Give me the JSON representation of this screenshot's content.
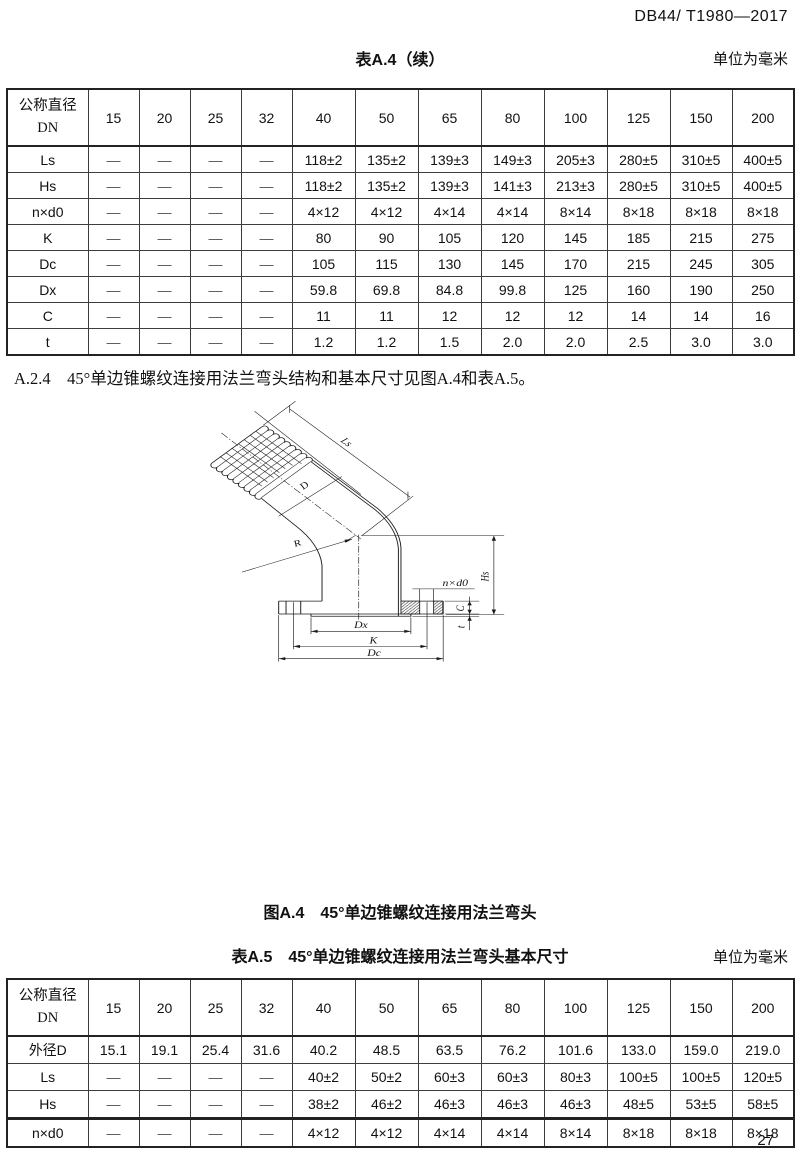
{
  "page": {
    "doc_code": "DB44/ T1980—2017",
    "page_number": "27"
  },
  "table_a4": {
    "title": "表A.4（续）",
    "unit_note": "单位为毫米",
    "header": {
      "label_line1": "公称直径",
      "label_line2": "DN",
      "columns": [
        "15",
        "20",
        "25",
        "32",
        "40",
        "50",
        "65",
        "80",
        "100",
        "125",
        "150",
        "200"
      ]
    },
    "rows": [
      {
        "label": "Ls",
        "values": [
          "—",
          "—",
          "—",
          "—",
          "118±2",
          "135±2",
          "139±3",
          "149±3",
          "205±3",
          "280±5",
          "310±5",
          "400±5"
        ]
      },
      {
        "label": "Hs",
        "values": [
          "—",
          "—",
          "—",
          "—",
          "118±2",
          "135±2",
          "139±3",
          "141±3",
          "213±3",
          "280±5",
          "310±5",
          "400±5"
        ]
      },
      {
        "label": "n×d0",
        "values": [
          "—",
          "—",
          "—",
          "—",
          "4×12",
          "4×12",
          "4×14",
          "4×14",
          "8×14",
          "8×18",
          "8×18",
          "8×18"
        ]
      },
      {
        "label": "K",
        "values": [
          "—",
          "—",
          "—",
          "—",
          "80",
          "90",
          "105",
          "120",
          "145",
          "185",
          "215",
          "275"
        ]
      },
      {
        "label": "Dc",
        "values": [
          "—",
          "—",
          "—",
          "—",
          "105",
          "115",
          "130",
          "145",
          "170",
          "215",
          "245",
          "305"
        ]
      },
      {
        "label": "Dx",
        "values": [
          "—",
          "—",
          "—",
          "—",
          "59.8",
          "69.8",
          "84.8",
          "99.8",
          "125",
          "160",
          "190",
          "250"
        ]
      },
      {
        "label": "C",
        "values": [
          "—",
          "—",
          "—",
          "—",
          "11",
          "11",
          "12",
          "12",
          "12",
          "14",
          "14",
          "16"
        ]
      },
      {
        "label": "t",
        "values": [
          "—",
          "—",
          "—",
          "—",
          "1.2",
          "1.2",
          "1.5",
          "2.0",
          "2.0",
          "2.5",
          "3.0",
          "3.0"
        ]
      }
    ]
  },
  "paragraph_a24": "A.2.4　45°单边锥螺纹连接用法兰弯头结构和基本尺寸见图A.4和表A.5。",
  "figure": {
    "caption": "图A.4　45°单边锥螺纹连接用法兰弯头",
    "labels": {
      "ls": "Ls",
      "d": "D",
      "r": "R",
      "hs": "Hs",
      "nxd0": "n×d0",
      "c": "C",
      "t": "t",
      "dx": "Dx",
      "k": "K",
      "dc": "Dc"
    }
  },
  "table_a5": {
    "title": "表A.5　45°单边锥螺纹连接用法兰弯头基本尺寸",
    "unit_note": "单位为毫米",
    "header": {
      "label_line1": "公称直径",
      "label_line2": "DN",
      "columns": [
        "15",
        "20",
        "25",
        "32",
        "40",
        "50",
        "65",
        "80",
        "100",
        "125",
        "150",
        "200"
      ]
    },
    "rows": [
      {
        "label": "外径D",
        "values": [
          "15.1",
          "19.1",
          "25.4",
          "31.6",
          "40.2",
          "48.5",
          "63.5",
          "76.2",
          "101.6",
          "133.0",
          "159.0",
          "219.0"
        ]
      },
      {
        "label": "Ls",
        "values": [
          "—",
          "—",
          "—",
          "—",
          "40±2",
          "50±2",
          "60±3",
          "60±3",
          "80±3",
          "100±5",
          "100±5",
          "120±5"
        ]
      },
      {
        "label": "Hs",
        "values": [
          "—",
          "—",
          "—",
          "—",
          "38±2",
          "46±2",
          "46±3",
          "46±3",
          "46±3",
          "48±5",
          "53±5",
          "58±5"
        ]
      },
      {
        "label": "n×d0",
        "values": [
          "—",
          "—",
          "—",
          "—",
          "4×12",
          "4×12",
          "4×14",
          "4×14",
          "8×14",
          "8×18",
          "8×18",
          "8×18"
        ]
      }
    ]
  }
}
